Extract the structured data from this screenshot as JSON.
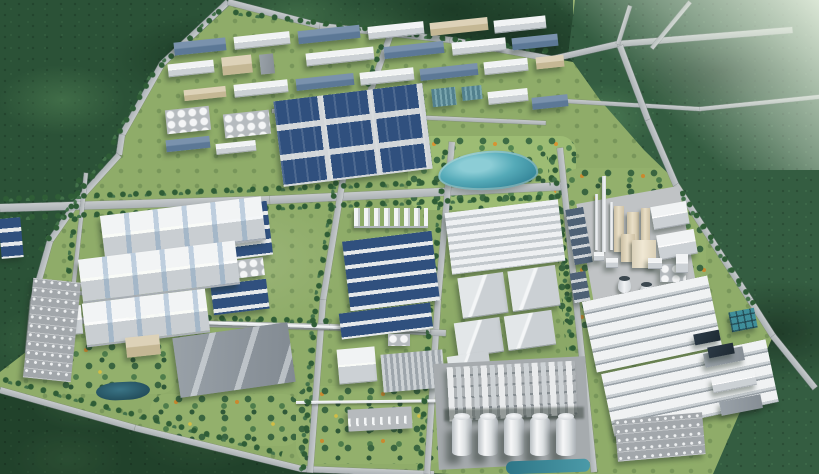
{
  "scene": {
    "description": "Aerial oblique 3D rendering of a large industrial park: factory campuses, blue- and white-roofed warehouses, a central lake park, a process plant with chimneys and cooling towers, a silo tank farm, water-treatment basins and parking lots, all surrounded by dense forest with access roads",
    "view": "aerial-oblique",
    "regions": [
      {
        "name": "forest-northwest",
        "label": "Dense forest (northwest)"
      },
      {
        "name": "forest-north-strip",
        "label": "Forest strip (north)"
      },
      {
        "name": "forest-east",
        "label": "Forest with access roads (east)"
      },
      {
        "name": "forest-southwest",
        "label": "Forest belt (southwest)"
      },
      {
        "name": "factory-campus-north",
        "label": "Mixed factory campus (north)"
      },
      {
        "name": "navy-roof-grid",
        "label": "Dark-blue roofed factory grid"
      },
      {
        "name": "lake-park",
        "label": "Central lake and landscaped park"
      },
      {
        "name": "white-warehouses-west",
        "label": "Large white warehouses (west)"
      },
      {
        "name": "blue-roof-rows-center",
        "label": "Blue-roofed production rows (center)"
      },
      {
        "name": "gray-warehouses-center",
        "label": "Gray warehouses (center-east)"
      },
      {
        "name": "office-and-gardens-southwest",
        "label": "Offices, gardens and pond (southwest)"
      },
      {
        "name": "process-plant-east",
        "label": "Process plant with stacks and cooling towers (east)"
      },
      {
        "name": "silo-plant-south",
        "label": "Chemical plant with storage silos (south)"
      },
      {
        "name": "warehouse-rows-southeast",
        "label": "Long warehouse rows (southeast)"
      },
      {
        "name": "water-treatment-southeast",
        "label": "Water treatment basins (southeast)"
      },
      {
        "name": "parking-lot-west",
        "label": "Employee parking (west)"
      },
      {
        "name": "parking-lot-southeast",
        "label": "Parking lot with cars (southeast)"
      }
    ]
  },
  "palette": {
    "forest_dark": "#1c3726",
    "forest_mid": "#2b5237",
    "forest_light": "#49754e",
    "haze": "#dfeadb",
    "park_green": "#8fac69",
    "garden_green": "#93b06c",
    "tree_green": "#2f5d36",
    "road_gray": "#abb1b4",
    "roof_white": "#f1f3f4",
    "roof_shade": "#ccd1d5",
    "wall_shade": "#a8aeb4",
    "roof_navy": "#30507e",
    "roof_slate": "#7a92ad",
    "roof_gray": "#9aa2a9",
    "roof_tan": "#ddd2b8",
    "glass_teal": "#52808d",
    "concrete_pad": "#c0c3c5",
    "plant_pad": "#a6abae",
    "lake_teal": "#2f7f93",
    "lake_light": "#8ccdd6",
    "pond_dark": "#234e5c",
    "pool_dark": "#1e2a33",
    "pool_teal": "#3f8e9a",
    "silo_white": "#f6f7f8",
    "chimney_white": "#f2f4f5",
    "tower_beige": "#e9dfc7",
    "flower_orange": "#c9892f"
  }
}
